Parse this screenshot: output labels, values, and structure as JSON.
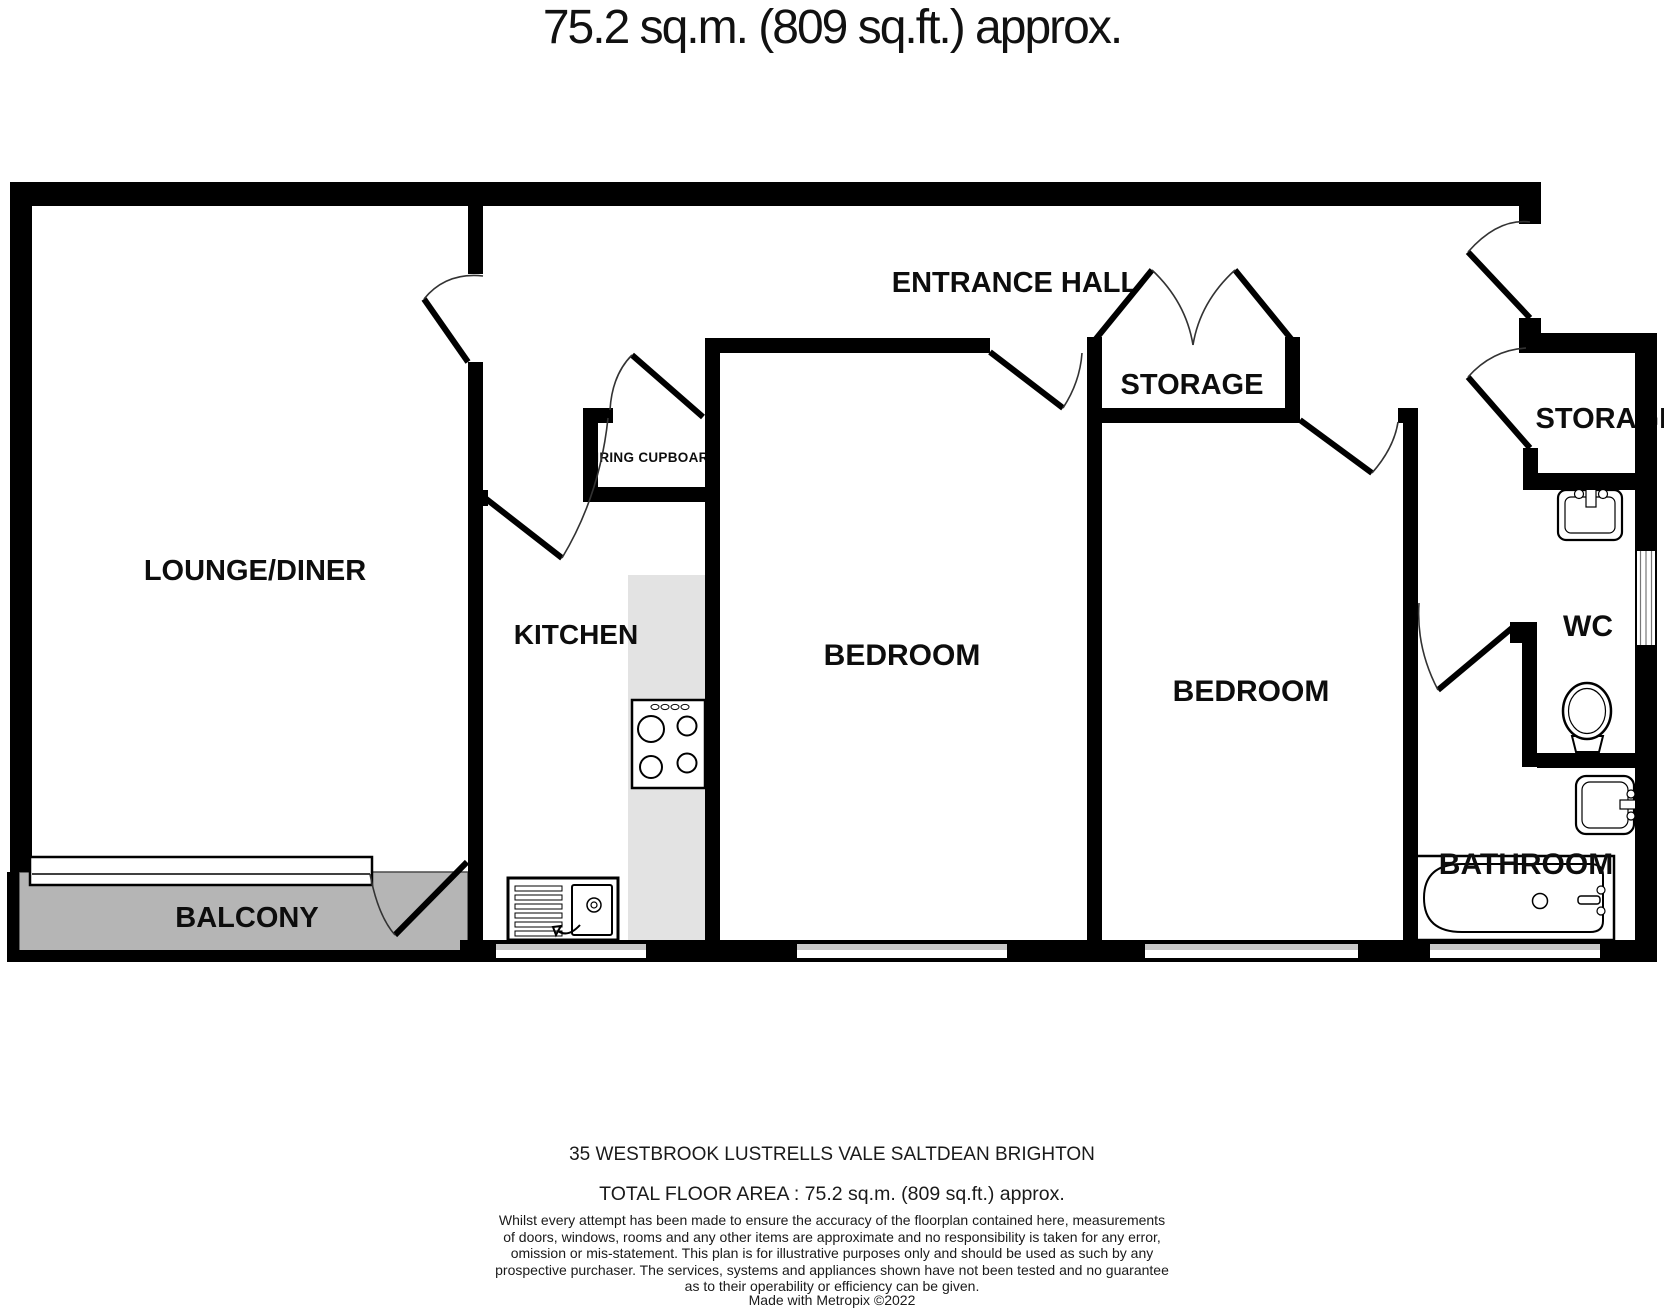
{
  "title": "75.2 sq.m. (809 sq.ft.) approx.",
  "rooms": {
    "lounge_diner": {
      "label": "LOUNGE/DINER"
    },
    "kitchen": {
      "label": "KITCHEN"
    },
    "entrance_hall": {
      "label": "ENTRANCE HALL"
    },
    "airing_cupboard": {
      "label": "AIRING CUPBOARD"
    },
    "storage_hall": {
      "label": "STORAGE"
    },
    "storage_right": {
      "label": "STORAGE"
    },
    "bedroom_1": {
      "label": "BEDROOM"
    },
    "bedroom_2": {
      "label": "BEDROOM"
    },
    "wc": {
      "label": "WC"
    },
    "bathroom": {
      "label": "BATHROOM"
    },
    "balcony": {
      "label": "BALCONY"
    }
  },
  "footer": {
    "address": "35 WESTBROOK LUSTRELLS VALE SALTDEAN BRIGHTON",
    "total_area": "TOTAL FLOOR AREA : 75.2 sq.m. (809 sq.ft.) approx.",
    "disclaimer": "Whilst every attempt has been made to ensure the accuracy of the floorplan contained here, measurements\nof doors, windows, rooms and any other items are approximate and no responsibility is taken for any error,\nomission or mis-statement. This plan is for illustrative purposes only and should be used as such by any\nprospective purchaser. The services, systems and appliances shown have not been tested and no guarantee\nas to their operability or efficiency can be given.",
    "credit": "Made with Metropix ©2022"
  },
  "colors": {
    "wall": "#000000",
    "balcony_fill": "#b5b5b5",
    "counter_fill": "#e3e3e3",
    "window_sill": "#c9c9c9"
  }
}
